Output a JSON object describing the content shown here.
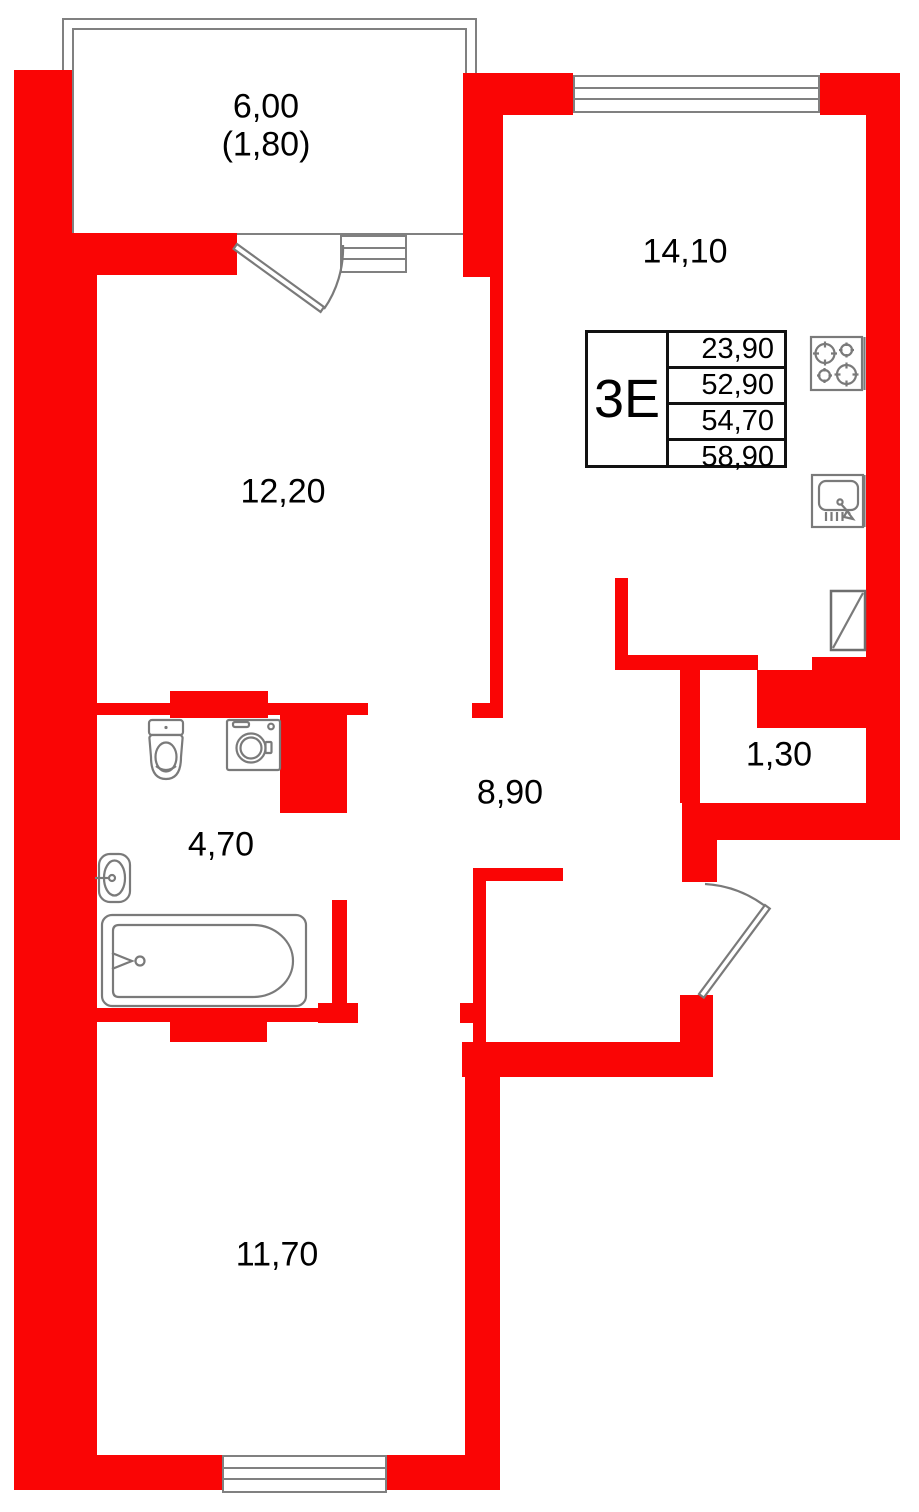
{
  "colors": {
    "wall_red": "#fa0505",
    "drawing_gray": "#808080",
    "text_black": "#000000",
    "card_border": "#111111"
  },
  "rooms": {
    "balcony": {
      "area": "6,00",
      "area_with_coefficient": "(1,80)"
    },
    "living_room": {
      "area": "12,20"
    },
    "kitchen_living_room": {
      "area": "14,10"
    },
    "bathroom": {
      "area": "4,70"
    },
    "hallway": {
      "area": "8,90"
    },
    "storage": {
      "area": "1,30"
    },
    "bedroom": {
      "area": "11,70"
    }
  },
  "apartment_card": {
    "type_label": "3Е",
    "area_rows": [
      "23,90",
      "52,90",
      "54,70",
      "58,90"
    ]
  },
  "icons": [
    "stove-icon",
    "kitchen-sink-icon",
    "vent-shaft-icon",
    "toilet-icon",
    "washing-machine-icon",
    "wash-basin-icon",
    "bathtub-icon",
    "balcony-door-icon",
    "entry-door-icon"
  ]
}
